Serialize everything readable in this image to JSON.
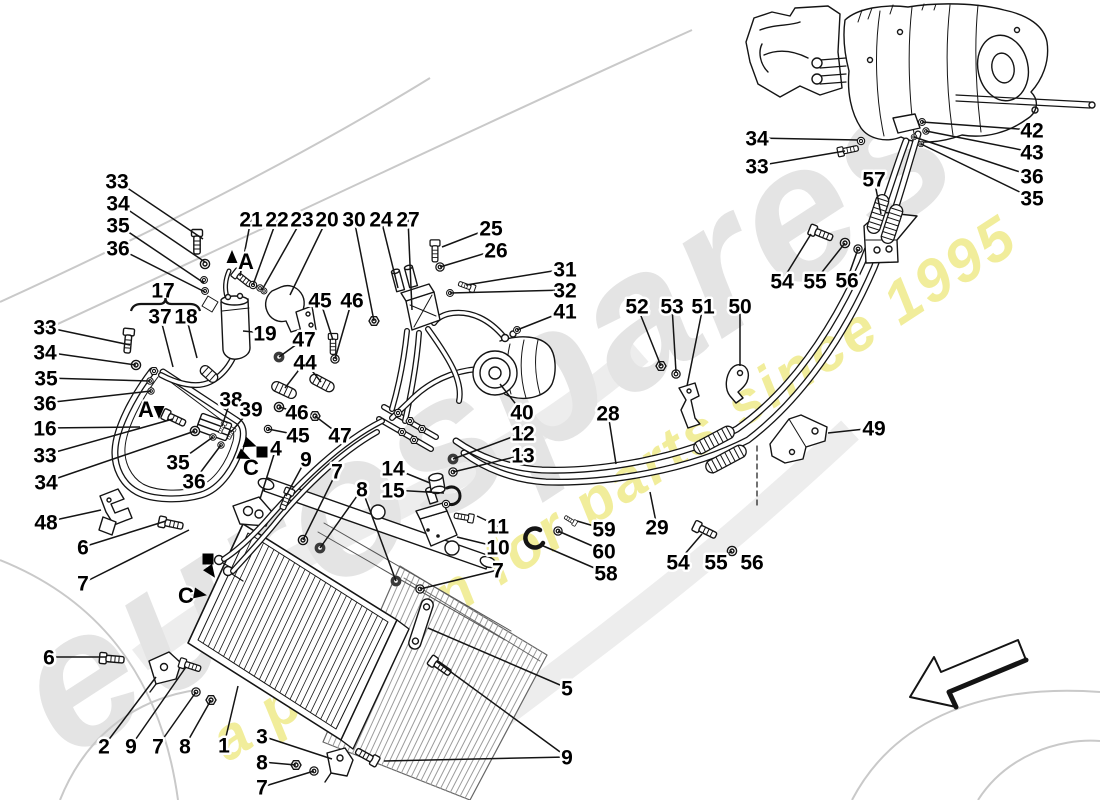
{
  "watermark": {
    "brand": "eurospares",
    "tagline": "a passion for parts since 1995"
  },
  "callouts": [
    {
      "t": "33",
      "x": 117,
      "y": 181,
      "leads": [
        [
          203,
          239
        ]
      ]
    },
    {
      "t": "34",
      "x": 118,
      "y": 203,
      "leads": [
        [
          205,
          262
        ]
      ]
    },
    {
      "t": "35",
      "x": 118,
      "y": 225,
      "leads": [
        [
          204,
          283
        ]
      ]
    },
    {
      "t": "36",
      "x": 118,
      "y": 248,
      "leads": [
        [
          205,
          292
        ]
      ]
    },
    {
      "t": "17",
      "x": 163,
      "y": 290,
      "leads": []
    },
    {
      "t": "37",
      "x": 160,
      "y": 316,
      "leads": [
        [
          173,
          367
        ]
      ]
    },
    {
      "t": "18",
      "x": 186,
      "y": 316,
      "leads": [
        [
          197,
          358
        ]
      ]
    },
    {
      "t": "21",
      "x": 251,
      "y": 219,
      "leads": [
        [
          240,
          276
        ]
      ]
    },
    {
      "t": "22",
      "x": 277,
      "y": 219,
      "leads": [
        [
          253,
          285
        ]
      ]
    },
    {
      "t": "23",
      "x": 302,
      "y": 219,
      "leads": [
        [
          262,
          290
        ]
      ]
    },
    {
      "t": "20",
      "x": 327,
      "y": 219,
      "leads": [
        [
          290,
          295
        ]
      ]
    },
    {
      "t": "30",
      "x": 354,
      "y": 219,
      "leads": [
        [
          374,
          321
        ]
      ]
    },
    {
      "t": "24",
      "x": 381,
      "y": 219,
      "leads": [
        [
          398,
          288
        ]
      ]
    },
    {
      "t": "27",
      "x": 408,
      "y": 219,
      "leads": [
        [
          412,
          310
        ]
      ]
    },
    {
      "t": "25",
      "x": 491,
      "y": 228,
      "leads": [
        [
          442,
          247
        ]
      ]
    },
    {
      "t": "26",
      "x": 496,
      "y": 250,
      "leads": [
        [
          440,
          267
        ]
      ]
    },
    {
      "t": "31",
      "x": 565,
      "y": 269,
      "leads": [
        [
          466,
          285
        ]
      ]
    },
    {
      "t": "32",
      "x": 565,
      "y": 290,
      "leads": [
        [
          450,
          293
        ]
      ]
    },
    {
      "t": "41",
      "x": 565,
      "y": 311,
      "leads": [
        [
          517,
          330
        ]
      ]
    },
    {
      "t": "19",
      "x": 265,
      "y": 333,
      "leads": [
        [
          243,
          331
        ]
      ]
    },
    {
      "t": "45",
      "x": 320,
      "y": 300,
      "leads": [
        [
          333,
          340
        ]
      ]
    },
    {
      "t": "46",
      "x": 352,
      "y": 300,
      "leads": [
        [
          335,
          359
        ]
      ]
    },
    {
      "t": "47",
      "x": 304,
      "y": 339,
      "leads": [
        [
          279,
          357
        ]
      ]
    },
    {
      "t": "44",
      "x": 305,
      "y": 362,
      "leads": [
        [
          285,
          388
        ],
        [
          321,
          382
        ]
      ]
    },
    {
      "t": "33",
      "x": 45,
      "y": 327,
      "leads": [
        [
          130,
          345
        ]
      ]
    },
    {
      "t": "34",
      "x": 45,
      "y": 352,
      "leads": [
        [
          136,
          365
        ]
      ]
    },
    {
      "t": "35",
      "x": 46,
      "y": 378,
      "leads": [
        [
          150,
          381
        ]
      ]
    },
    {
      "t": "36",
      "x": 45,
      "y": 403,
      "leads": [
        [
          151,
          391
        ]
      ]
    },
    {
      "t": "16",
      "x": 45,
      "y": 428,
      "leads": [
        [
          140,
          427
        ]
      ]
    },
    {
      "t": "33",
      "x": 45,
      "y": 455,
      "leads": [
        [
          173,
          419
        ]
      ]
    },
    {
      "t": "34",
      "x": 46,
      "y": 482,
      "leads": [
        [
          195,
          431
        ]
      ]
    },
    {
      "t": "35",
      "x": 178,
      "y": 462,
      "leads": [
        [
          213,
          437
        ]
      ]
    },
    {
      "t": "36",
      "x": 194,
      "y": 481,
      "leads": [
        [
          221,
          445
        ]
      ]
    },
    {
      "t": "38",
      "x": 231,
      "y": 399,
      "leads": [
        [
          222,
          426
        ]
      ]
    },
    {
      "t": "39",
      "x": 251,
      "y": 409,
      "leads": [
        [
          231,
          432
        ]
      ]
    },
    {
      "t": "46",
      "x": 297,
      "y": 412,
      "leads": [
        [
          279,
          407
        ]
      ]
    },
    {
      "t": "45",
      "x": 298,
      "y": 435,
      "leads": [
        [
          268,
          429
        ]
      ]
    },
    {
      "t": "47",
      "x": 340,
      "y": 435,
      "leads": [
        [
          315,
          416
        ]
      ]
    },
    {
      "t": "48",
      "x": 46,
      "y": 522,
      "leads": [
        [
          101,
          510
        ]
      ]
    },
    {
      "t": "6",
      "x": 83,
      "y": 547,
      "leads": [
        [
          166,
          521
        ]
      ]
    },
    {
      "t": "7",
      "x": 83,
      "y": 583,
      "leads": [
        [
          189,
          530
        ]
      ]
    },
    {
      "t": "6",
      "x": 49,
      "y": 657,
      "leads": [
        [
          106,
          657
        ]
      ]
    },
    {
      "t": "4",
      "x": 276,
      "y": 448,
      "leads": [
        [
          260,
          499
        ]
      ]
    },
    {
      "t": "9",
      "x": 306,
      "y": 459,
      "leads": [
        [
          286,
          496
        ]
      ]
    },
    {
      "t": "7",
      "x": 337,
      "y": 471,
      "leads": [
        [
          303,
          540
        ]
      ]
    },
    {
      "t": "8",
      "x": 362,
      "y": 489,
      "leads": [
        [
          320,
          548
        ],
        [
          396,
          581
        ]
      ]
    },
    {
      "t": "7",
      "x": 498,
      "y": 570,
      "leads": [
        [
          420,
          589
        ]
      ]
    },
    {
      "t": "12",
      "x": 523,
      "y": 433,
      "leads": [
        [
          453,
          459
        ]
      ]
    },
    {
      "t": "13",
      "x": 523,
      "y": 455,
      "leads": [
        [
          453,
          472
        ]
      ]
    },
    {
      "t": "14",
      "x": 393,
      "y": 468,
      "leads": [
        [
          430,
          483
        ]
      ]
    },
    {
      "t": "15",
      "x": 393,
      "y": 490,
      "leads": [
        [
          444,
          493
        ]
      ]
    },
    {
      "t": "11",
      "x": 498,
      "y": 526,
      "leads": [
        [
          477,
          516
        ]
      ]
    },
    {
      "t": "10",
      "x": 498,
      "y": 547,
      "leads": [
        [
          457,
          537
        ]
      ]
    },
    {
      "t": "40",
      "x": 522,
      "y": 412,
      "leads": [
        [
          500,
          384
        ]
      ]
    },
    {
      "t": "28",
      "x": 608,
      "y": 413,
      "leads": [
        [
          616,
          464
        ]
      ]
    },
    {
      "t": "29",
      "x": 657,
      "y": 527,
      "leads": [
        [
          650,
          492
        ]
      ]
    },
    {
      "t": "52",
      "x": 637,
      "y": 306,
      "leads": [
        [
          661,
          366
        ]
      ]
    },
    {
      "t": "53",
      "x": 672,
      "y": 306,
      "leads": [
        [
          676,
          372
        ]
      ]
    },
    {
      "t": "51",
      "x": 703,
      "y": 306,
      "leads": [
        [
          687,
          386
        ]
      ]
    },
    {
      "t": "50",
      "x": 740,
      "y": 306,
      "leads": [
        [
          740,
          366
        ]
      ]
    },
    {
      "t": "49",
      "x": 874,
      "y": 428,
      "leads": [
        [
          828,
          433
        ]
      ]
    },
    {
      "t": "54",
      "x": 678,
      "y": 562,
      "leads": [
        [
          702,
          534
        ]
      ]
    },
    {
      "t": "55",
      "x": 716,
      "y": 562,
      "leads": [
        [
          732,
          551
        ]
      ]
    },
    {
      "t": "56",
      "x": 752,
      "y": 562,
      "leads": [
        [
          748,
          558
        ]
      ]
    },
    {
      "t": "59",
      "x": 604,
      "y": 529,
      "leads": [
        [
          577,
          521
        ]
      ]
    },
    {
      "t": "60",
      "x": 604,
      "y": 551,
      "leads": [
        [
          558,
          531
        ]
      ]
    },
    {
      "t": "58",
      "x": 606,
      "y": 573,
      "leads": [
        [
          541,
          545
        ]
      ]
    },
    {
      "t": "5",
      "x": 567,
      "y": 688,
      "leads": [
        [
          428,
          628
        ]
      ]
    },
    {
      "t": "9",
      "x": 567,
      "y": 757,
      "leads": [
        [
          436,
          661
        ],
        [
          384,
          761
        ]
      ]
    },
    {
      "t": "2",
      "x": 104,
      "y": 746,
      "leads": [
        [
          156,
          677
        ]
      ]
    },
    {
      "t": "9",
      "x": 131,
      "y": 746,
      "leads": [
        [
          186,
          667
        ]
      ]
    },
    {
      "t": "7",
      "x": 158,
      "y": 746,
      "leads": [
        [
          196,
          692
        ]
      ]
    },
    {
      "t": "8",
      "x": 185,
      "y": 746,
      "leads": [
        [
          211,
          700
        ]
      ]
    },
    {
      "t": "1",
      "x": 224,
      "y": 745,
      "leads": [
        [
          238,
          686
        ]
      ]
    },
    {
      "t": "3",
      "x": 262,
      "y": 736,
      "leads": [
        [
          332,
          759
        ]
      ]
    },
    {
      "t": "8",
      "x": 262,
      "y": 762,
      "leads": [
        [
          296,
          765
        ]
      ]
    },
    {
      "t": "7",
      "x": 262,
      "y": 787,
      "leads": [
        [
          314,
          771
        ]
      ]
    },
    {
      "t": "34",
      "x": 757,
      "y": 138,
      "leads": [
        [
          858,
          140
        ]
      ]
    },
    {
      "t": "33",
      "x": 757,
      "y": 166,
      "leads": [
        [
          845,
          151
        ]
      ]
    },
    {
      "t": "42",
      "x": 1032,
      "y": 130,
      "leads": [
        [
          922,
          122
        ]
      ]
    },
    {
      "t": "43",
      "x": 1032,
      "y": 152,
      "leads": [
        [
          926,
          131
        ]
      ]
    },
    {
      "t": "36",
      "x": 1032,
      "y": 176,
      "leads": [
        [
          914,
          137
        ]
      ]
    },
    {
      "t": "35",
      "x": 1032,
      "y": 198,
      "leads": [
        [
          921,
          144
        ]
      ]
    },
    {
      "t": "57",
      "x": 874,
      "y": 179,
      "leads": [
        [
          881,
          214
        ]
      ]
    },
    {
      "t": "54",
      "x": 782,
      "y": 281,
      "leads": [
        [
          811,
          234
        ]
      ]
    },
    {
      "t": "55",
      "x": 815,
      "y": 281,
      "leads": [
        [
          845,
          243
        ]
      ]
    },
    {
      "t": "56",
      "x": 847,
      "y": 280,
      "leads": [
        [
          858,
          249
        ]
      ]
    }
  ],
  "markers": {
    "letters": [
      {
        "ch": "A",
        "x": 246,
        "y": 269
      },
      {
        "ch": "A",
        "x": 146,
        "y": 417
      },
      {
        "ch": "C",
        "x": 251,
        "y": 475
      },
      {
        "ch": "C",
        "x": 186,
        "y": 603
      }
    ],
    "squares": [
      {
        "x": 262,
        "y": 452
      },
      {
        "x": 208,
        "y": 559
      }
    ],
    "arrows": [
      {
        "x": 232,
        "y": 257,
        "rot": -90
      },
      {
        "x": 159,
        "y": 412,
        "rot": 90
      },
      {
        "x": 250,
        "y": 444,
        "rot": 20
      },
      {
        "x": 244,
        "y": 456,
        "rot": 25
      },
      {
        "x": 211,
        "y": 572,
        "rot": 55
      },
      {
        "x": 200,
        "y": 594,
        "rot": 10
      }
    ]
  },
  "brace": {
    "x1": 131,
    "x2": 200,
    "y": 305
  }
}
